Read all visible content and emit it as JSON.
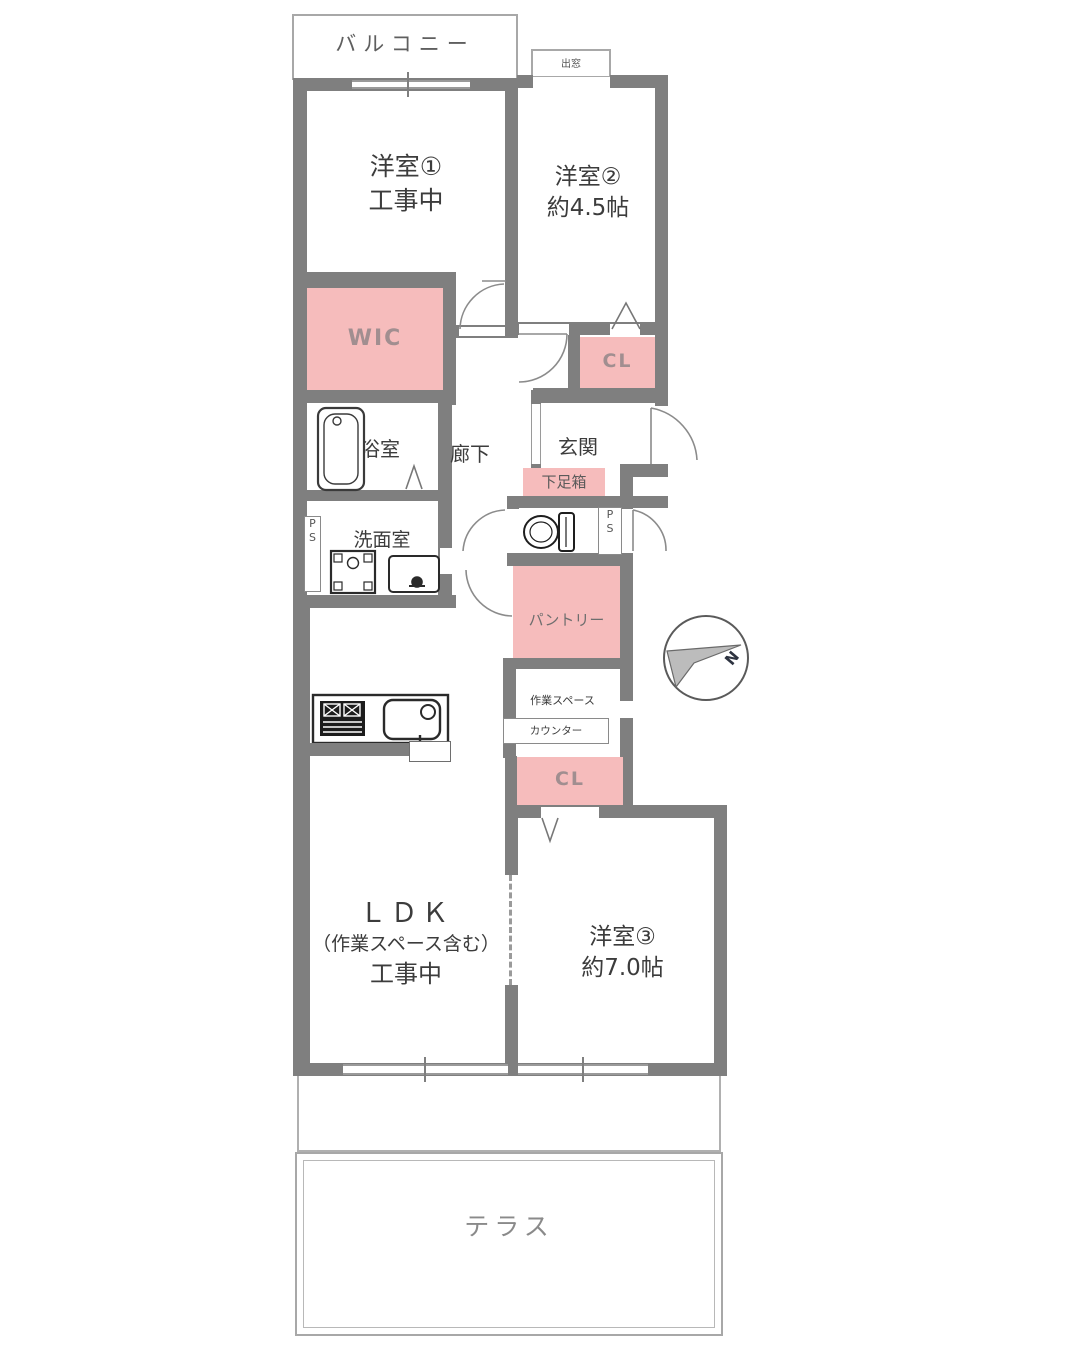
{
  "colors": {
    "wall": "#7f7f7f",
    "room_fill": "#ffffff",
    "closet_pink": "#f6bcbc",
    "outline_gray": "#a8a8a8",
    "text_dark": "#3c3c3c",
    "text_muted": "#8a8a8a",
    "pink_label_text": "#a18e90"
  },
  "labels": {
    "balcony": "バルコニー",
    "room1_name": "洋室①",
    "room1_status": "工事中",
    "room2_name": "洋室②",
    "room2_size": "約4.5帖",
    "bay_window": "出窓",
    "wic": "WIC",
    "closet_upper": "CL",
    "bath": "浴室",
    "corridor": "廊下",
    "entrance": "玄関",
    "shoe_box": "下足箱",
    "ps_p": "P",
    "ps_s": "S",
    "washroom": "洗面室",
    "pantry": "パントリー",
    "work_space": "作業スペース",
    "counter": "カウンター",
    "closet_lower": "CL",
    "ldk_name": "ＬＤＫ",
    "ldk_note": "（作業スペース含む）",
    "ldk_status": "工事中",
    "room3_name": "洋室③",
    "room3_size": "約7.0帖",
    "terrace": "テラス",
    "compass_north": "N"
  }
}
